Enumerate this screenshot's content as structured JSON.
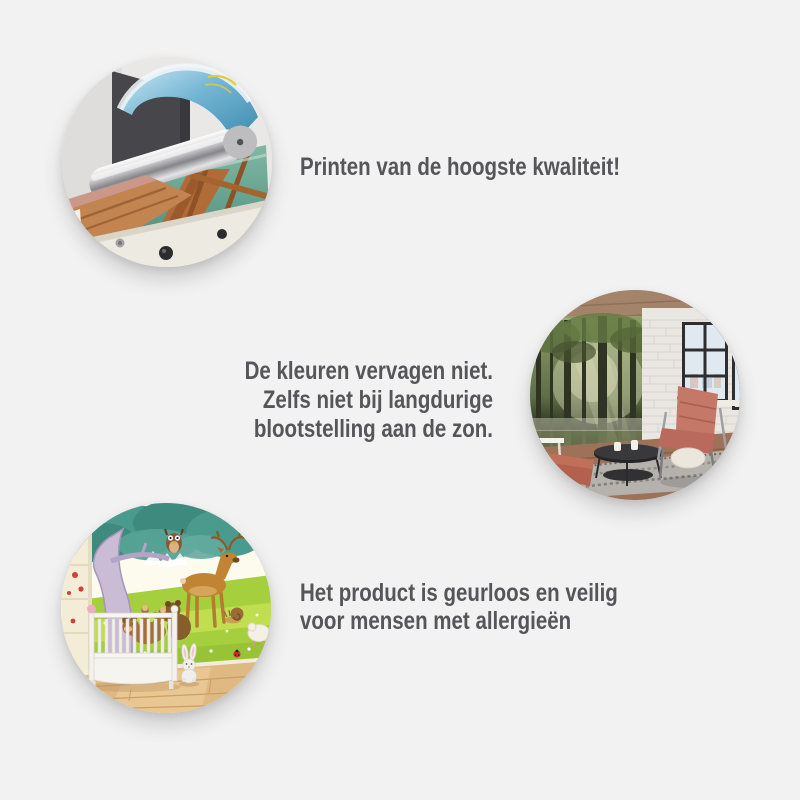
{
  "page": {
    "background_color": "#f2f2f2",
    "text_color": "#55555a"
  },
  "features": [
    {
      "alt": "Large-format printer printing a canvas of a wooden pier over turquoise water",
      "lines": [
        "Printen van de hoogste kwaliteit!"
      ]
    },
    {
      "alt": "Loft living room with sunlit forest wall mural, salmon leather armchair, round black coffee table and tall windows",
      "lines": [
        "De kleuren vervagen niet.",
        "Zelfs niet bij langdurige",
        "blootstelling aan de zon."
      ]
    },
    {
      "alt": "Nursery with cartoon animal wall mural, white crib and plush bunny on a wooden floor",
      "lines": [
        "Het product is geurloos en veilig",
        "voor mensen met allergieën"
      ]
    }
  ]
}
